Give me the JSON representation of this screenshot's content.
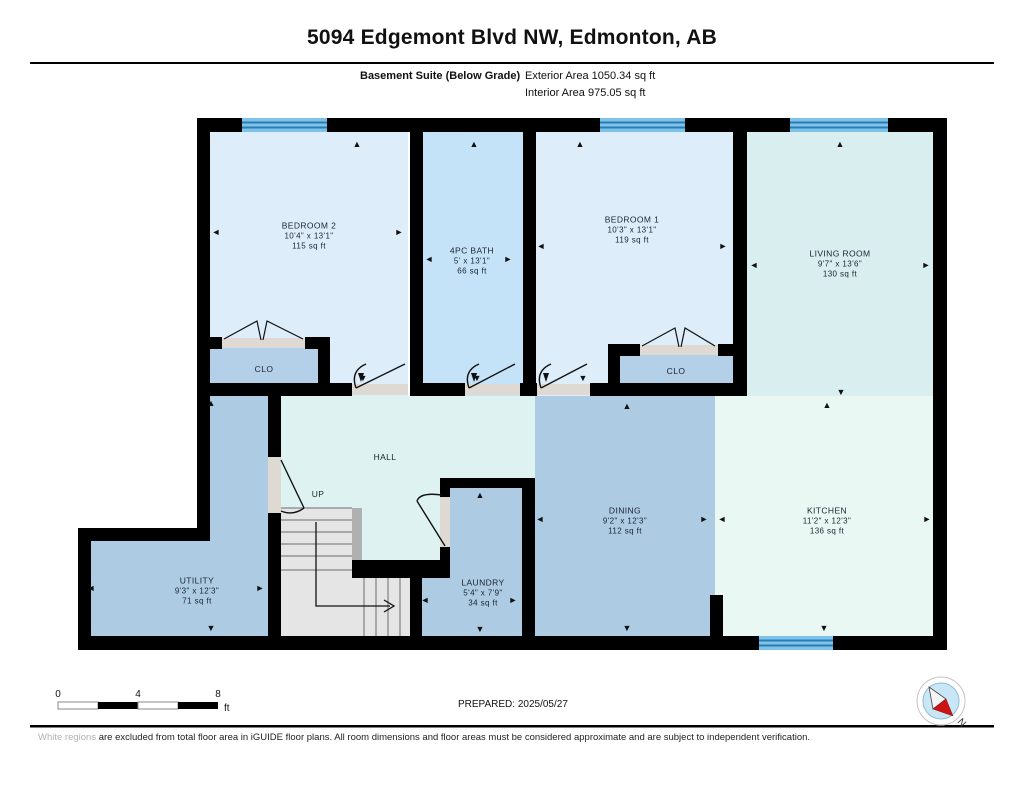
{
  "header": {
    "title": "5094 Edgemont Blvd NW, Edmonton, AB",
    "suite_label": "Basement Suite (Below Grade)",
    "exterior_area": "Exterior Area 1050.34 sq ft",
    "interior_area": "Interior Area 975.05 sq ft"
  },
  "rooms": {
    "bedroom2": {
      "name": "BEDROOM 2",
      "dims": "10'4\" x 13'1\"",
      "area": "115 sq ft"
    },
    "bath": {
      "name": "4PC BATH",
      "dims": "5' x 13'1\"",
      "area": "66 sq ft"
    },
    "bedroom1": {
      "name": "BEDROOM 1",
      "dims": "10'3\" x 13'1\"",
      "area": "119 sq ft"
    },
    "living": {
      "name": "LIVING ROOM",
      "dims": "9'7\" x 13'6\"",
      "area": "130 sq ft"
    },
    "dining": {
      "name": "DINING",
      "dims": "9'2\" x 12'3\"",
      "area": "112 sq ft"
    },
    "kitchen": {
      "name": "KITCHEN",
      "dims": "11'2\" x 12'3\"",
      "area": "136 sq ft"
    },
    "utility": {
      "name": "UTILITY",
      "dims": "9'3\" x 12'3\"",
      "area": "71 sq ft"
    },
    "laundry": {
      "name": "LAUNDRY",
      "dims": "5'4\" x 7'9\"",
      "area": "34 sq ft"
    },
    "closet": "CLO",
    "hall": "HALL",
    "up": "UP"
  },
  "icons": {
    "arrow_left": "◄",
    "arrow_right": "►",
    "arrow_up": "▲",
    "arrow_down": "▼"
  },
  "footer": {
    "scale_0": "0",
    "scale_4": "4",
    "scale_8": "8",
    "scale_unit": "ft",
    "prepared": "PREPARED: 2025/05/27",
    "compass_n": "N",
    "disclaimer_faded": "White regions",
    "disclaimer_rest": " are excluded from total floor area in iGUIDE floor plans. All room dimensions and floor areas must be considered approximate and are subject to independent verification."
  },
  "palette": {
    "wall": "#000000",
    "bedroom": "#ddeefa",
    "bath": "#c5e3f8",
    "living": "#d9eeef",
    "hall": "#def2f1",
    "dining": "#adcbe3",
    "kitchen": "#eaf8f3",
    "closet": "#b4d0e8",
    "stairs": "#e5e5e5",
    "door_sill": "#ded9d3",
    "window": "#7dc2e8",
    "window_stripe": "#2d7cb0"
  }
}
